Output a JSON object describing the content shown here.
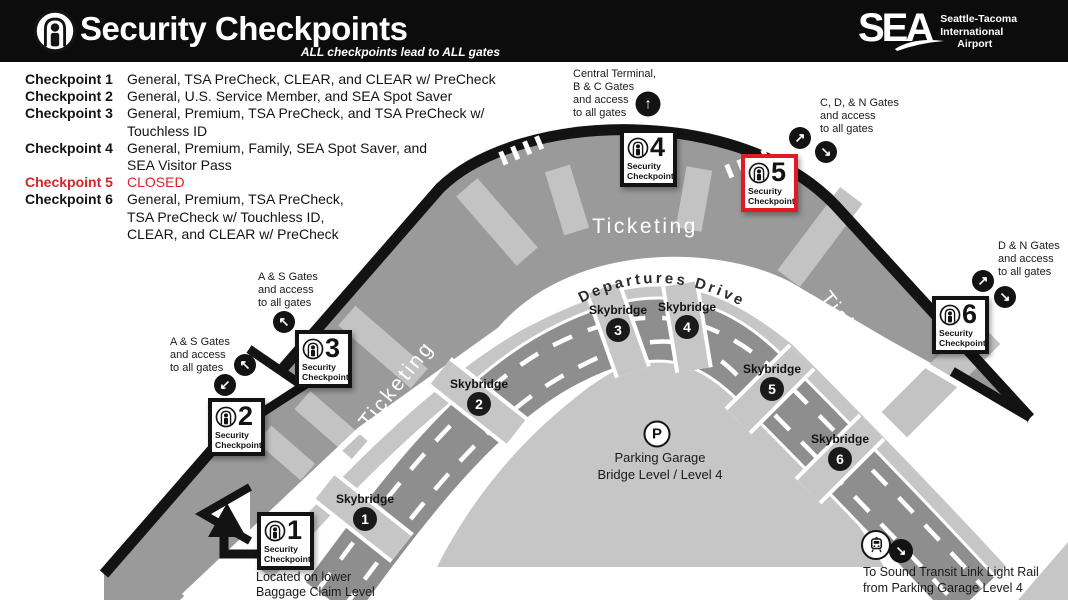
{
  "header": {
    "title": "Security Checkpoints",
    "subtitle": "ALL checkpoints lead to ALL gates",
    "logo": {
      "sea": "SEA",
      "line1": "Seattle-Tacoma",
      "line2": "International",
      "line3": "Airport"
    }
  },
  "legend": {
    "rows": [
      {
        "label": "Checkpoint 1",
        "desc": "General, TSA PreCheck, CLEAR, and CLEAR w/ PreCheck"
      },
      {
        "label": "Checkpoint 2",
        "desc": "General, U.S. Service Member, and SEA Spot Saver"
      },
      {
        "label": "Checkpoint 3",
        "desc": "General, Premium, TSA PreCheck, and TSA PreCheck w/\nTouchless ID"
      },
      {
        "label": "Checkpoint 4",
        "desc": "General, Premium, Family, SEA Spot Saver, and\nSEA Visitor Pass"
      },
      {
        "label": "Checkpoint 5",
        "desc": "CLOSED"
      },
      {
        "label": "Checkpoint 6",
        "desc": "General, Premium, TSA PreCheck,\nTSA PreCheck w/ Touchless ID,\nCLEAR, and CLEAR w/ PreCheck"
      }
    ]
  },
  "map": {
    "ticketing": "Ticketing",
    "departures_drive": "Departures Drive",
    "skybridge_label": "Skybridge",
    "skybridge_numbers": [
      "1",
      "2",
      "3",
      "4",
      "5",
      "6"
    ],
    "checkpoint_label": "Security\nCheckpoint",
    "checkpoint_numbers": [
      "1",
      "2",
      "3",
      "4",
      "5",
      "6"
    ],
    "parking": {
      "icon": "P",
      "text": "Parking Garage\nBridge Level / Level 4"
    },
    "notes": {
      "central": "Central Terminal,\nB & C Gates\nand access\nto all gates",
      "cdn": "C, D, & N Gates\nand access\nto all gates",
      "dn": "D & N Gates\nand access\nto all gates",
      "as_upper": "A & S Gates\nand access\nto all gates",
      "as_lower": "A & S Gates\nand access\nto all gates",
      "checkpoint1": "Located on lower\nBaggage Claim Level",
      "light_rail": "To Sound Transit Link Light Rail\nfrom Parking Garage Level 4"
    },
    "icons": {
      "up": "↑",
      "up_right": "↗",
      "down_right": "↘",
      "up_left": "↖",
      "down_left": "↙"
    }
  },
  "colors": {
    "header_black": "#0c0c0d",
    "accent_red": "#e01b23",
    "closed_red": "#d8232a",
    "band_gray": "#9a9a9b",
    "road_gray": "#8e8e8f",
    "light_gray": "#c6c6c7"
  }
}
